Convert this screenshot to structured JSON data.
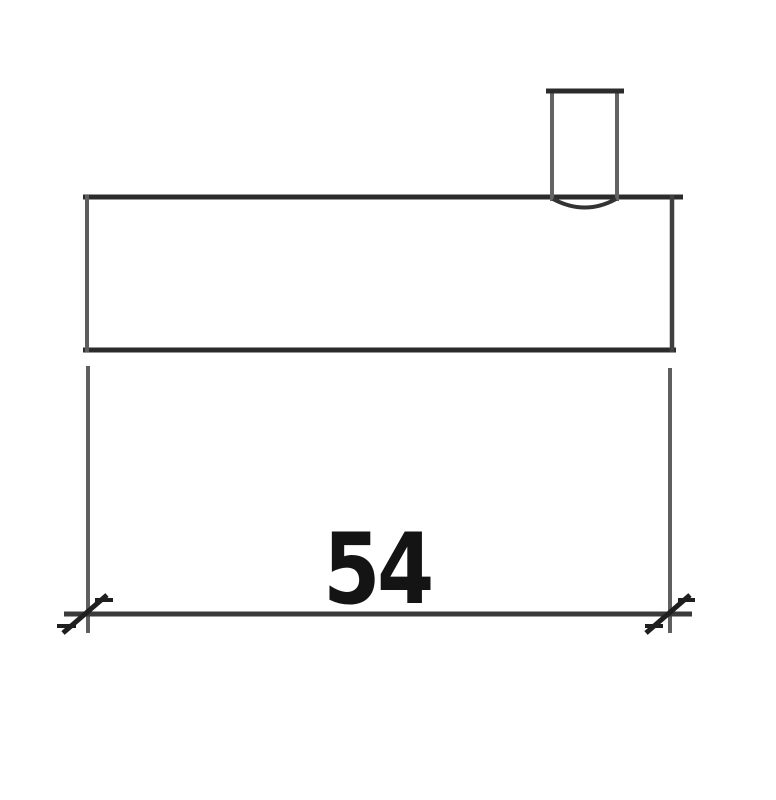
{
  "drawing": {
    "dimension_label": "54",
    "colors": {
      "background": "#ffffff",
      "outline_heavy": "#2b2b2b",
      "outline_light": "#5d5d5d",
      "outline_medium": "#3f3f3f",
      "tab_side": "#636363",
      "tab_bottom": "#333333",
      "extension": "#5f5f5f",
      "dimension_line": "#3a3a3a",
      "tick": "#1f1f1f",
      "text": "#141414"
    }
  }
}
